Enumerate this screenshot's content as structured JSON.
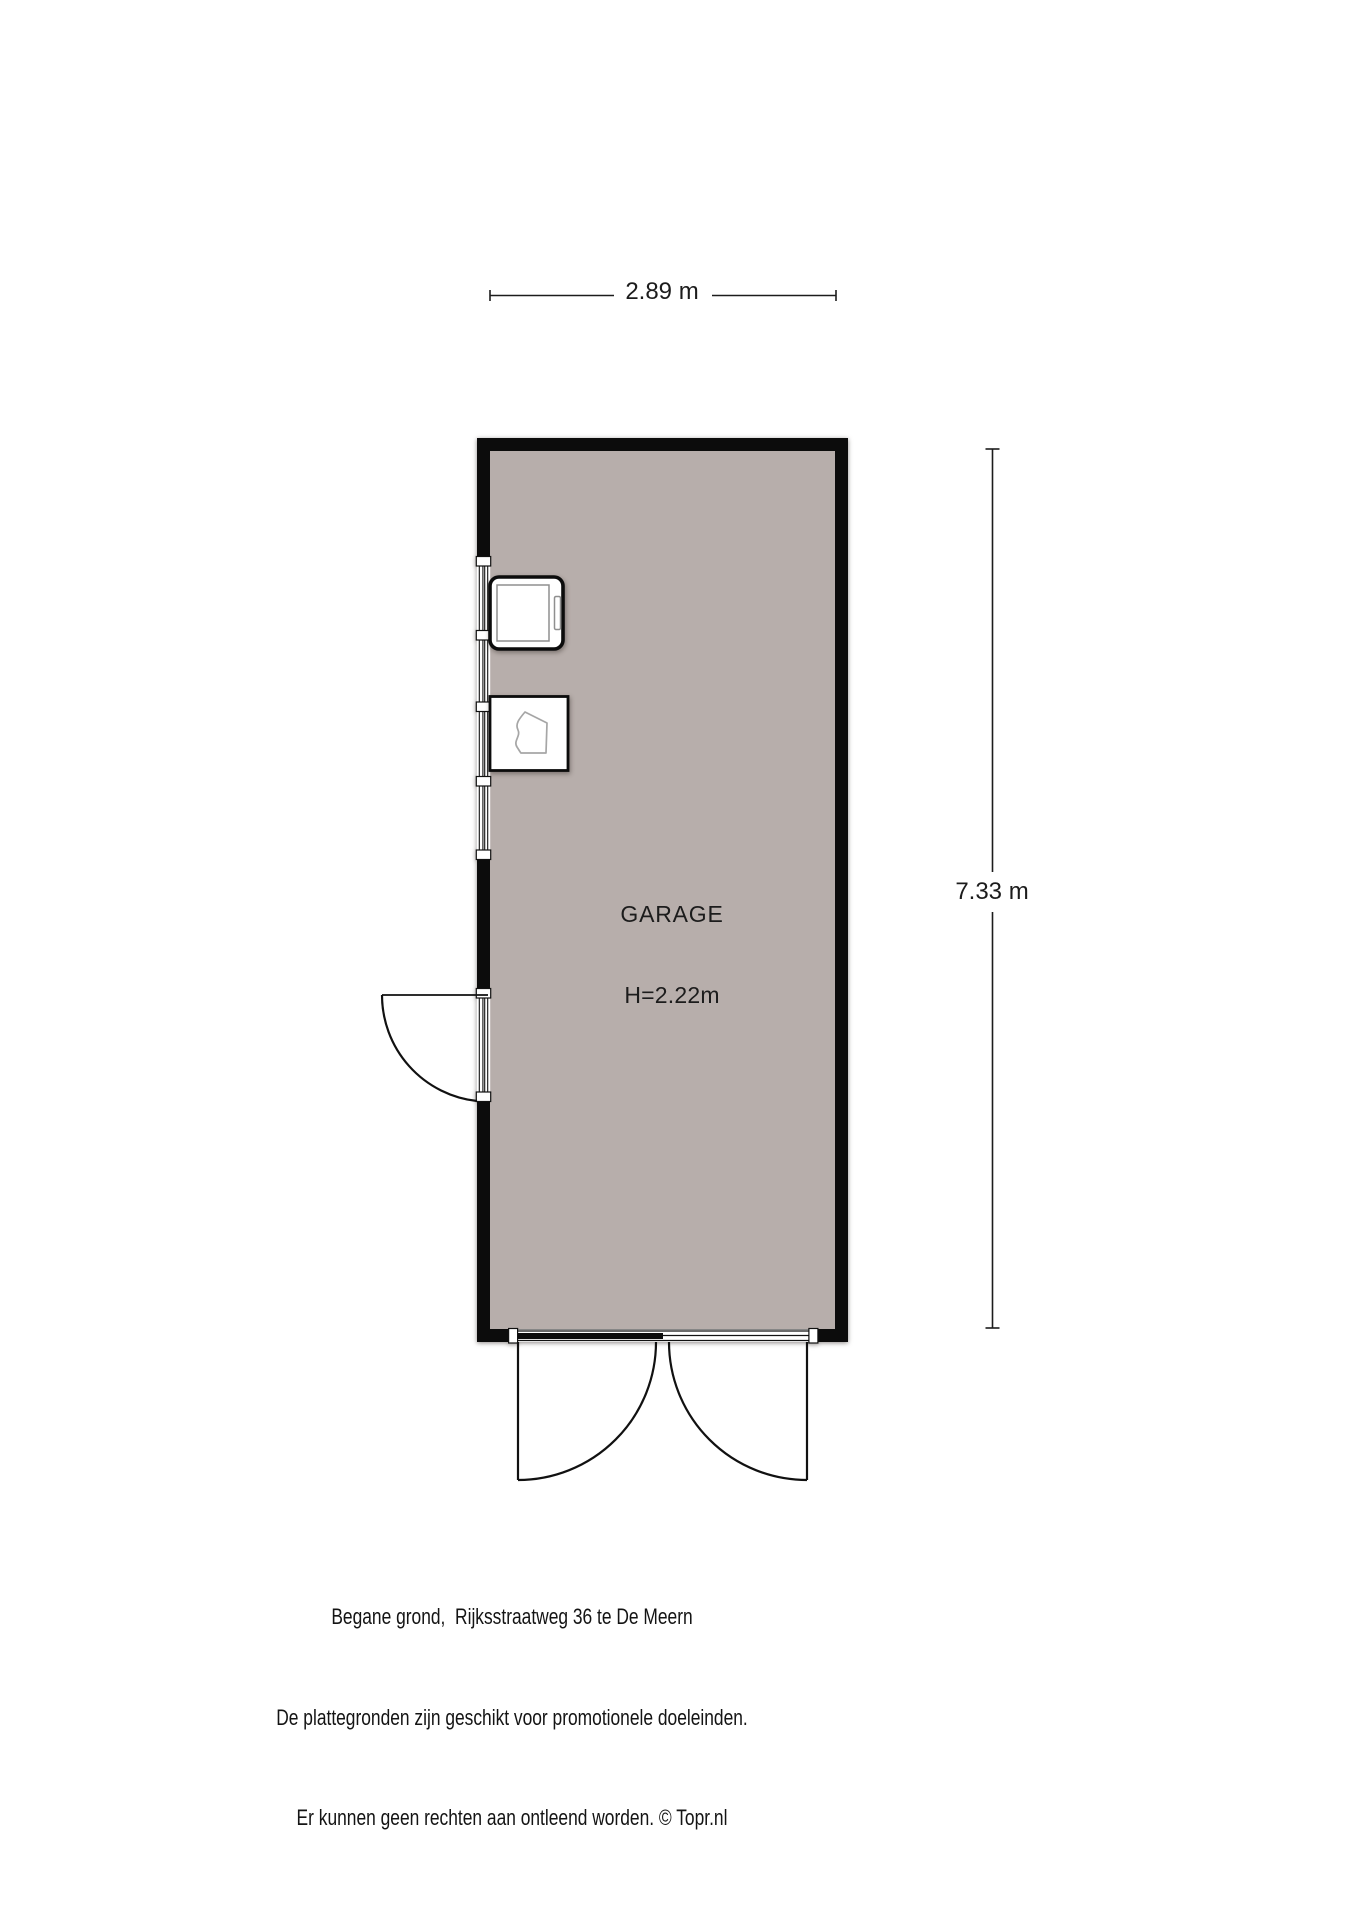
{
  "page": {
    "background": "#ffffff"
  },
  "floorplan": {
    "room": {
      "name": "GARAGE",
      "ceiling_height": "H=2.22m"
    },
    "dimensions": {
      "width": "2.89 m",
      "height": "7.33 m"
    },
    "colors": {
      "wall": "#0c0c0c",
      "floor": "#b7aeab",
      "opening": "#ffffff",
      "fixture_sketch": "#a6a6a6",
      "dimension_line": "#1c1c1c"
    },
    "fixtures": [
      {
        "name": "washing-machine"
      },
      {
        "name": "storage-unit"
      }
    ],
    "openings": [
      {
        "name": "window-left"
      },
      {
        "name": "side-door-left"
      },
      {
        "name": "double-garage-door-bottom"
      }
    ]
  },
  "caption": {
    "lines": [
      "Begane grond,  Rijksstraatweg 36 te De Meern",
      "De plattegronden zijn geschikt voor promotionele doeleinden.",
      "Er kunnen geen rechten aan ontleend worden. © Topr.nl"
    ]
  }
}
